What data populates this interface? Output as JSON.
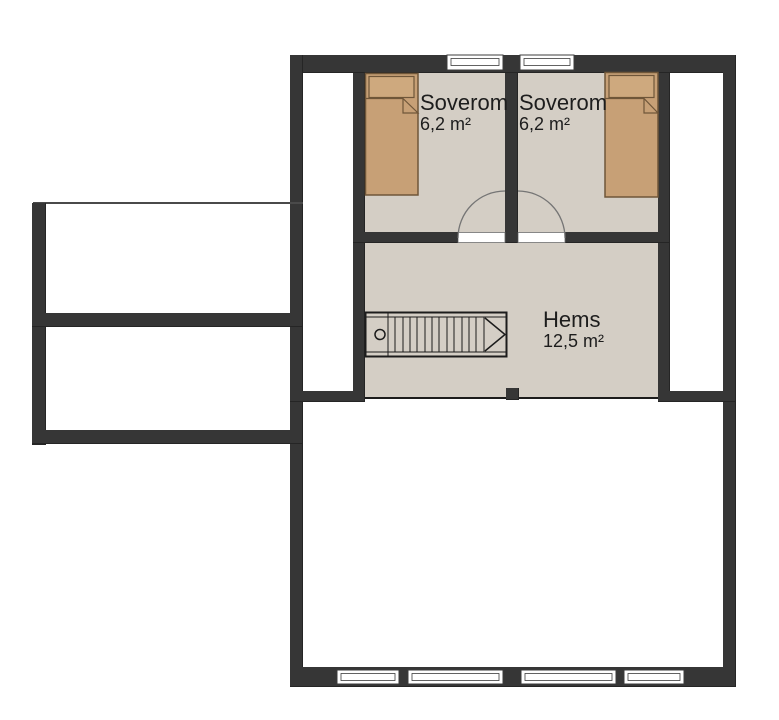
{
  "colors": {
    "wall": "#363636",
    "floor": "#d4cec5",
    "bed_fill": "#c7a076",
    "bed_pillow": "#cea97e",
    "bed_outline": "#6f5639",
    "line": "#1c1c1c",
    "door_arc": "#757575",
    "window_frame": "#3c3c3c",
    "annex_line": "#4a4a4a",
    "background": "#ffffff",
    "text": "#1d1d1d"
  },
  "rooms": [
    {
      "name": "Soverom",
      "area": "6,2 m²"
    },
    {
      "name": "Soverom",
      "area": "6,2 m²"
    },
    {
      "name": "Hems",
      "area": "12,5 m²"
    }
  ]
}
